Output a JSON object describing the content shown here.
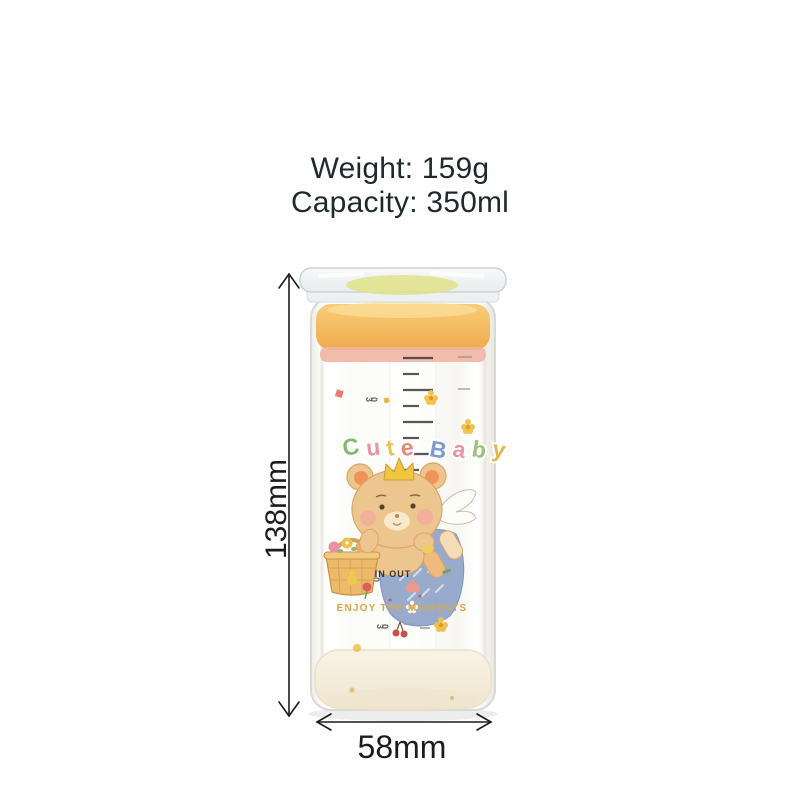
{
  "page": {
    "background": "#ffffff"
  },
  "specs": {
    "weight": "Weight: 159g",
    "capacity": "Capacity: 350ml",
    "text_color": "#1e2a29"
  },
  "dimensions": {
    "height": "138mm",
    "width": "58mm",
    "annotation_color": "#1c1c1c"
  },
  "bottle": {
    "brand": "Cute Baby",
    "brand_letters": [
      {
        "ch": "C",
        "color": "#82b96d"
      },
      {
        "ch": "u",
        "color": "#e795a3"
      },
      {
        "ch": "t",
        "color": "#e9c356"
      },
      {
        "ch": "e",
        "color": "#e08a77"
      },
      {
        "ch": "B",
        "color": "#7e9bd1"
      },
      {
        "ch": "a",
        "color": "#e795a3"
      },
      {
        "ch": "b",
        "color": "#9cc179"
      },
      {
        "ch": "y",
        "color": "#e4b64c"
      }
    ],
    "in_out": "IN OUT",
    "slogan": "ENJOY THE MOMENTS",
    "slogan_color": "#d9a64e",
    "scale_marks": [
      "30",
      "30",
      "30",
      "30"
    ],
    "colors": {
      "lid": "#f2f5f5",
      "lid_ring": "#dfe183",
      "seal": "#f3bc5f",
      "gasket": "#f1b5a3",
      "glass_edge": "#dadad4",
      "base": "#f7f0e1"
    }
  }
}
